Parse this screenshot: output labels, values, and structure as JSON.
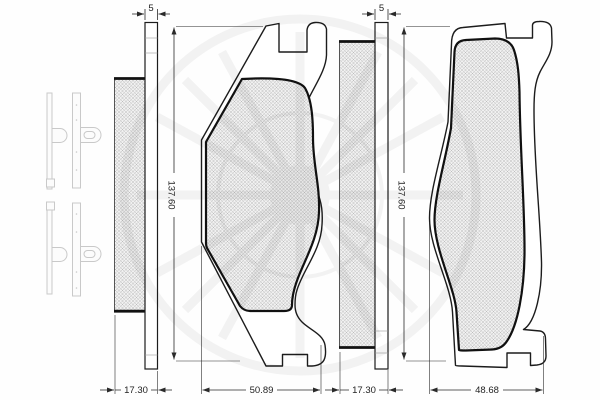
{
  "drawing": {
    "type": "technical-drawing",
    "subject": "disc-brake-pad-set",
    "views": {
      "left": {
        "plate_thickness": "5",
        "pad_height": "137.60",
        "assembly_depth": "17.30",
        "pad_width": "50.89"
      },
      "right": {
        "plate_thickness": "5",
        "pad_height": "137.60",
        "assembly_depth": "17.30",
        "pad_width": "48.68"
      }
    },
    "colors": {
      "outline": "#1c1c1c",
      "friction_outline": "#111111",
      "dimension": "#2a2a2a",
      "hatch_line": "#b6b6b6",
      "hatch_bg": "#f1f1f1",
      "accessory": "#c9c9c9",
      "watermark": "#000000"
    }
  }
}
